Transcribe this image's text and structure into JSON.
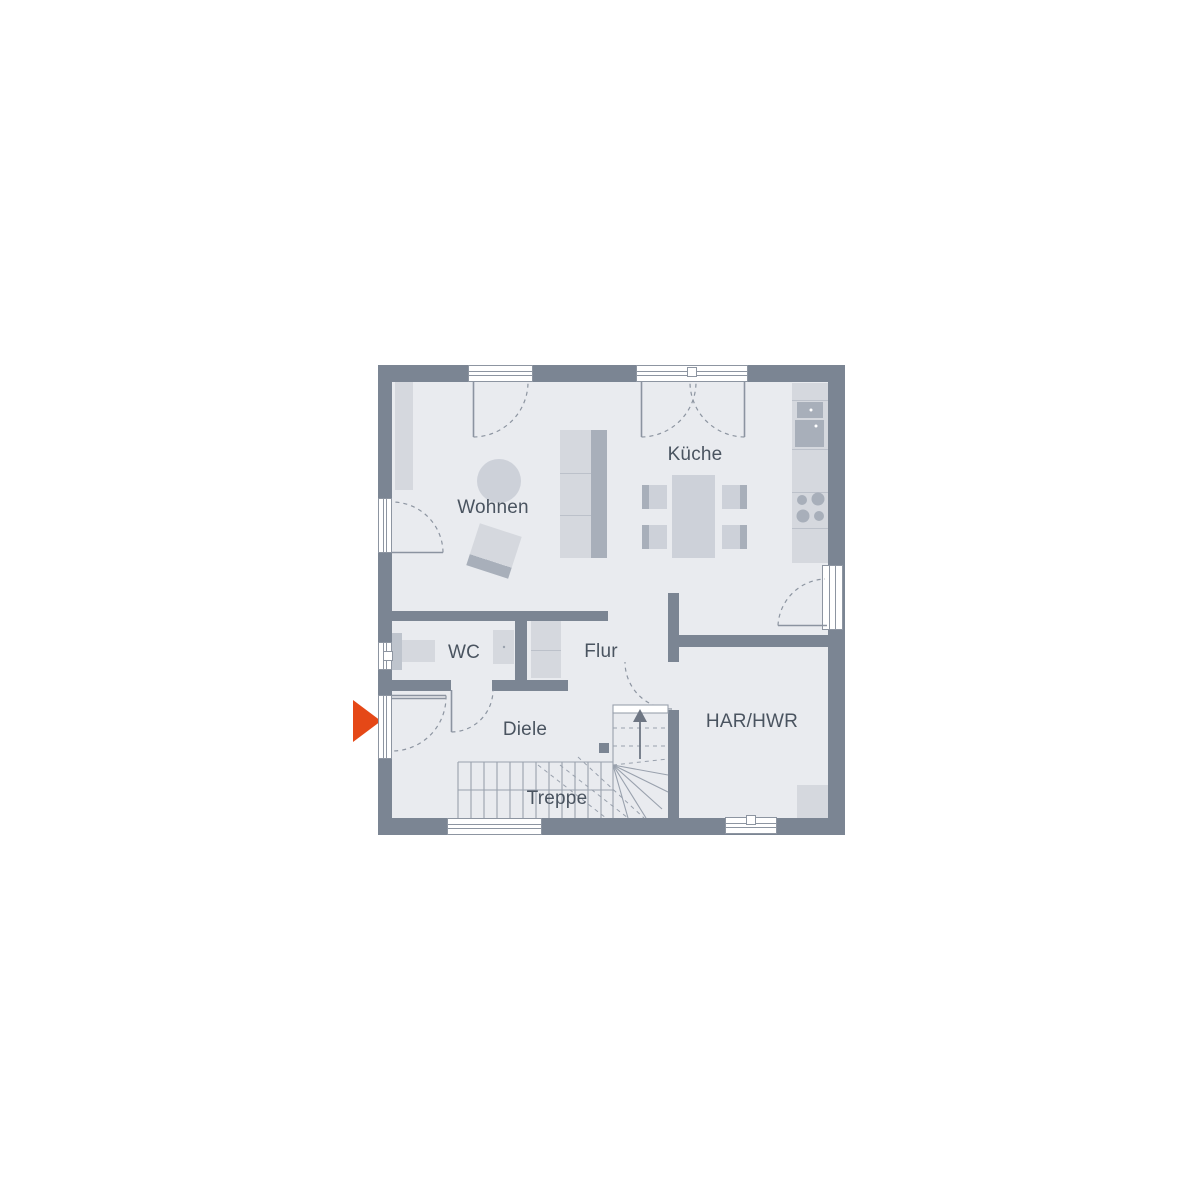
{
  "plan": {
    "type": "floor-plan",
    "rooms": [
      {
        "id": "wohnen",
        "label": "Wohnen"
      },
      {
        "id": "kueche",
        "label": "Küche"
      },
      {
        "id": "wc",
        "label": "WC"
      },
      {
        "id": "flur",
        "label": "Flur"
      },
      {
        "id": "diele",
        "label": "Diele"
      },
      {
        "id": "har-hwr",
        "label": "HAR/HWR"
      },
      {
        "id": "treppe",
        "label": "Treppe"
      }
    ]
  },
  "colors": {
    "canvas": "#ffffff",
    "wall": "#7b8593",
    "floor": "#e9ebef",
    "furniture": "#d5d8de",
    "furniture_mid": "#cdd1d9",
    "furniture_dark": "#a8afba",
    "line": "#8d95a1",
    "stair_line": "#99a1ad",
    "text": "#4a5460",
    "window": "#ffffff",
    "arrow": "#e54817"
  }
}
